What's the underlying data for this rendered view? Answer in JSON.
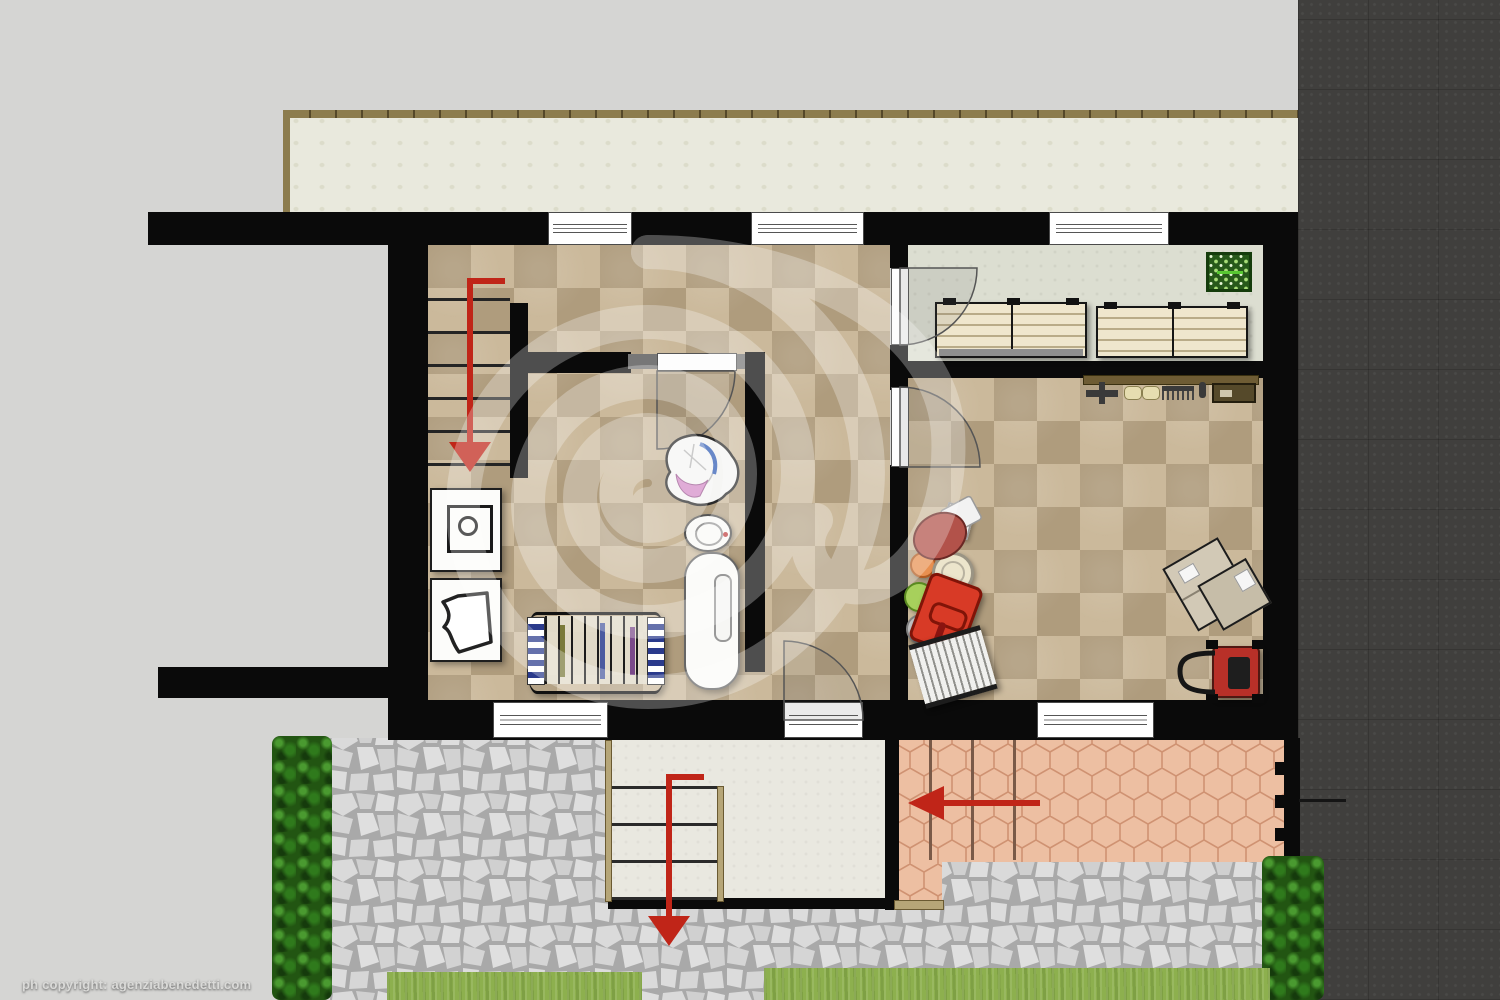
{
  "document_type": "residential basement floor plan rendering",
  "copyright": "ph copyright: agenziabenedetti.com",
  "watermark": {
    "name": "spiral-snail-watermark",
    "color": "#ffffff",
    "opacity": 0.28
  },
  "palette": {
    "background": "#d5d5d3",
    "wall": "#0a0a0a",
    "asphalt_road": "#403f3d",
    "tile_light": "#cbb99b",
    "tile_dark": "#af9c7d",
    "storage_floor": "#dcded1",
    "terrace_deck": "#e9e9dd",
    "deck_rail": "#8c7c4e",
    "stone_paving": "#d8d8d8",
    "stone_joint": "#a9a9a9",
    "terracotta": "#edbfa2",
    "terracotta_joint": "#cf9272",
    "hedge_green": "#2c6a1a",
    "lawn_green": "#8db04e",
    "descent_arrow_red": "#c02518",
    "landing": "#e9e8e0",
    "wood_rail": "#b6a678",
    "shelf_wood": "#efe6cd",
    "pegboard_green": "#27591a",
    "toolbox_red": "#d83a26",
    "mower_red": "#b83028"
  },
  "rooms": [
    {
      "name": "stair-hall",
      "floor": "beige checker tile",
      "features": [
        "staircase-down",
        "descent-arrow"
      ]
    },
    {
      "name": "bathroom-laundry",
      "floor": "beige checker tile",
      "furniture": [
        "washing-machine",
        "laundry-sink",
        "drying-rack",
        "laundry-basket",
        "toilet",
        "bathtub"
      ]
    },
    {
      "name": "hallway",
      "floor": "beige checker tile",
      "features": [
        "exterior-door-south"
      ]
    },
    {
      "name": "storage-room",
      "floor": "pale gray",
      "furniture": [
        "wood-shelf-unit-1",
        "wood-shelf-unit-2",
        "green-pegboard"
      ]
    },
    {
      "name": "workshop-garage",
      "floor": "beige checker tile",
      "furniture": [
        "tool-workbench",
        "watering-can",
        "paint-buckets",
        "toolbox",
        "step-ladder",
        "cardboard-boxes",
        "lawn-mower"
      ]
    }
  ],
  "exterior": [
    "upper-terrace-deck",
    "open-annex-court",
    "stone-paved-yard",
    "exterior-stair-landing",
    "terracotta-patio-with-steps",
    "boundary-fence",
    "hedge-left",
    "hedge-right",
    "lawn-strip-1",
    "lawn-strip-2",
    "asphalt-road-right"
  ],
  "openings": {
    "windows_north": 3,
    "windows_south": 2,
    "doors": [
      "bathroom-door",
      "storage-door",
      "workshop-door",
      "exterior-south-door"
    ]
  },
  "arrows": [
    {
      "name": "interior-staircase-descent",
      "direction": "down"
    },
    {
      "name": "exterior-stair-descent",
      "direction": "down"
    },
    {
      "name": "patio-steps-descent",
      "direction": "left"
    }
  ]
}
